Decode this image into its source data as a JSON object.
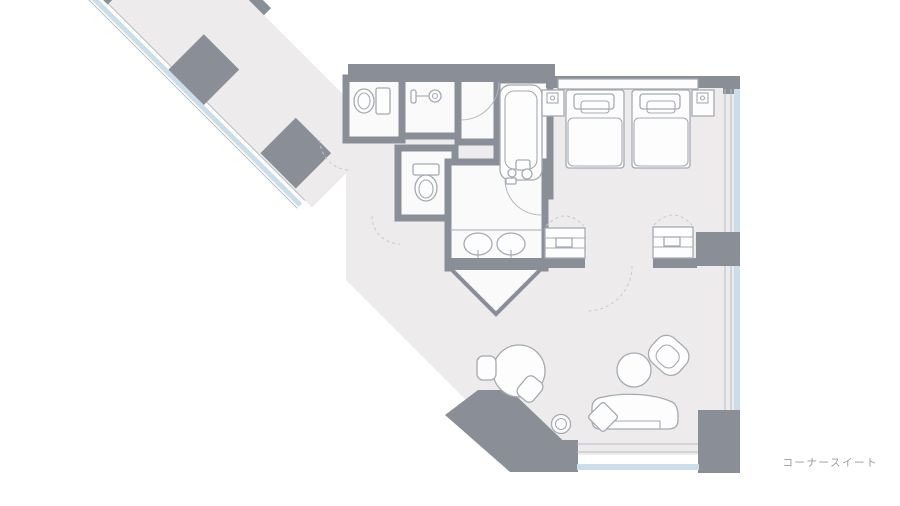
{
  "label": {
    "text": "コーナースイート"
  },
  "colors": {
    "background": "#FFFFFF",
    "wall": "#8A8E96",
    "floor": "#EDEBEC",
    "room_fill": "#FAFAFB",
    "window_glass": "#CBDDE8",
    "furniture_stroke": "#A5AAB2",
    "door_swing_dashed": "#C6CAD0",
    "label_text": "#9A9A9A"
  },
  "legend": {
    "fixtures": [
      "entry-vestibule",
      "closet",
      "powder-room-sink",
      "toilet",
      "shower",
      "bathtub",
      "double-vanity",
      "twin-bed",
      "nightstand-lamp",
      "luggage-bench",
      "dining-table-chairs",
      "coffee-table",
      "armchair",
      "chaise-lounge",
      "side-stool",
      "window-wall",
      "structural-pillar"
    ]
  }
}
